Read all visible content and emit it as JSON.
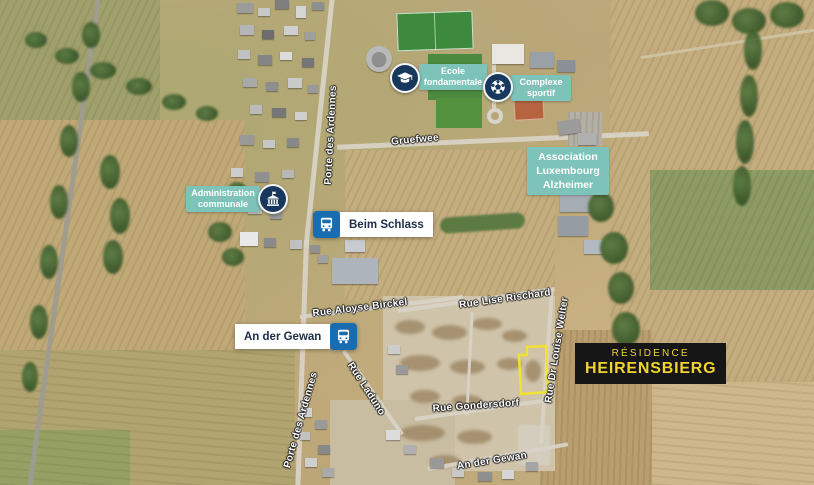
{
  "map": {
    "title": "Résidence Heirensbierg aerial location map",
    "pois": {
      "ecole": {
        "label": "Ecole\nfondamentale",
        "icon": "graduation-cap-icon"
      },
      "complexe": {
        "label": "Complexe\nsportif",
        "icon": "soccer-ball-icon"
      },
      "administration": {
        "label": "Administration\ncommunale",
        "icon": "town-hall-icon"
      },
      "alzheimer": {
        "label": "Association\nLuxembourg\nAlzheimer"
      },
      "beim_schlass": {
        "label": "Beim Schlass",
        "icon": "bus-icon"
      },
      "an_der_gewan_stop": {
        "label": "An der Gewan",
        "icon": "bus-icon"
      }
    },
    "streets": {
      "gruefwee": "Gruefwee",
      "porte_des_ardennes_north": "Porte des Ardennes",
      "porte_des_ardennes_south": "Porte des Ardennes",
      "rue_aloyse_birckel": "Rue Aloyse Birckel",
      "rue_lise_rischard": "Rue Lise Rischard",
      "rue_dr_louise_welter": "Rue Dr Louise Welter",
      "rue_laduno": "Rue Laduno",
      "rue_gondersdorf": "Rue Gondersdorf",
      "an_der_gewan_street": "An der Gewan"
    },
    "residence": {
      "line1": "RÉSIDENCE",
      "line2": "HEIRENSBIERG"
    },
    "colors": {
      "poi_label_bg": "#7ec3b9",
      "poi_icon_bg": "#17375c",
      "bus_icon_bg": "#1a6cb0",
      "stop_label_bg": "#ffffff",
      "stop_label_text": "#1c2e49",
      "residence_bg": "#161616",
      "residence_text": "#f2d42e",
      "plot_outline": "#f2e230"
    }
  }
}
